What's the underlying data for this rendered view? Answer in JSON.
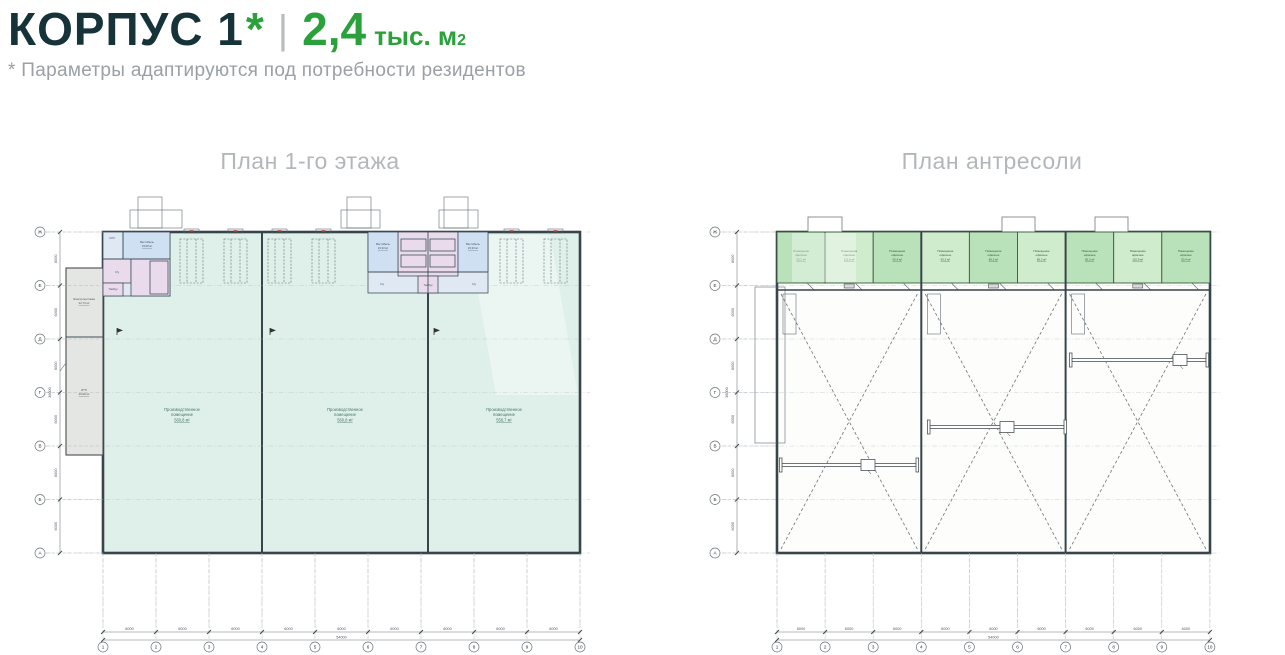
{
  "header": {
    "title": "КОРПУС 1",
    "asterisk": "*",
    "separator": "|",
    "area_value": "2,4",
    "area_unit": "тыс. м",
    "area_superscript": "2",
    "note": "* Параметры адаптируются под потребности резидентов"
  },
  "plan_left": {
    "title": "План 1-го этажа"
  },
  "plan_right": {
    "title": "План антресоли"
  },
  "grid": {
    "cols": [
      "1",
      "2",
      "3",
      "4",
      "5",
      "6",
      "7",
      "8",
      "9",
      "10"
    ],
    "rows": [
      "Ж",
      "Е",
      "Д",
      "Г",
      "В",
      "Б",
      "А"
    ],
    "bay_dim": "6000",
    "total_width": "54000",
    "row_dim": "6000",
    "total_height": "36000"
  },
  "floor1": {
    "halls": [
      {
        "name": "Производственное помещение",
        "area": "560,8 м²"
      },
      {
        "name": "Производственное помещение",
        "area": "560,8 м²"
      },
      {
        "name": "Производственное помещение",
        "area": "558,7 м²"
      }
    ],
    "annex_rooms": [
      {
        "name": "Электрощитовая",
        "area": "22,73 м²"
      },
      {
        "name": "ИТП",
        "area": "49,98 м²"
      }
    ],
    "vestibule_left": {
      "name": "Вестибюль",
      "area": "33,08 м²"
    },
    "vestibule_mid": {
      "name": "Вестибюль",
      "area": "23,33 м²"
    },
    "small_rooms": {
      "wc": "С/у",
      "cleaning": "КУИ",
      "tambour": "Тамбур"
    }
  },
  "mezzanine": {
    "rooms": [
      {
        "name": "Помещение офисное",
        "area": "50,2 м²"
      },
      {
        "name": "Помещение офисное",
        "area": "111,6 м²"
      },
      {
        "name": "Помещение офисное",
        "area": "50,4 м²"
      },
      {
        "name": "Помещение офисное",
        "area": "50,2 м²"
      },
      {
        "name": "Помещение офисное",
        "area": "80,2 м²"
      },
      {
        "name": "Помещение офисное",
        "area": "80,2 м²"
      },
      {
        "name": "Помещение офисное",
        "area": "50,2 м²"
      },
      {
        "name": "Помещение офисное",
        "area": "110,9 м²"
      },
      {
        "name": "Помещение офисное",
        "area": "50,4 м²"
      }
    ]
  },
  "colors": {
    "accent_green": "#2aa13a",
    "title_dark": "#16333a",
    "note_gray": "#9aa0a5",
    "plan_title_gray": "#b2b7ba",
    "hall_fill": "#dff0ea",
    "mezz_room_fill": "#b9e2ba",
    "vestibule_fill": "#cfe0f2",
    "stair_fill": "#e9dbec",
    "annex_fill": "#e4e6e3"
  }
}
